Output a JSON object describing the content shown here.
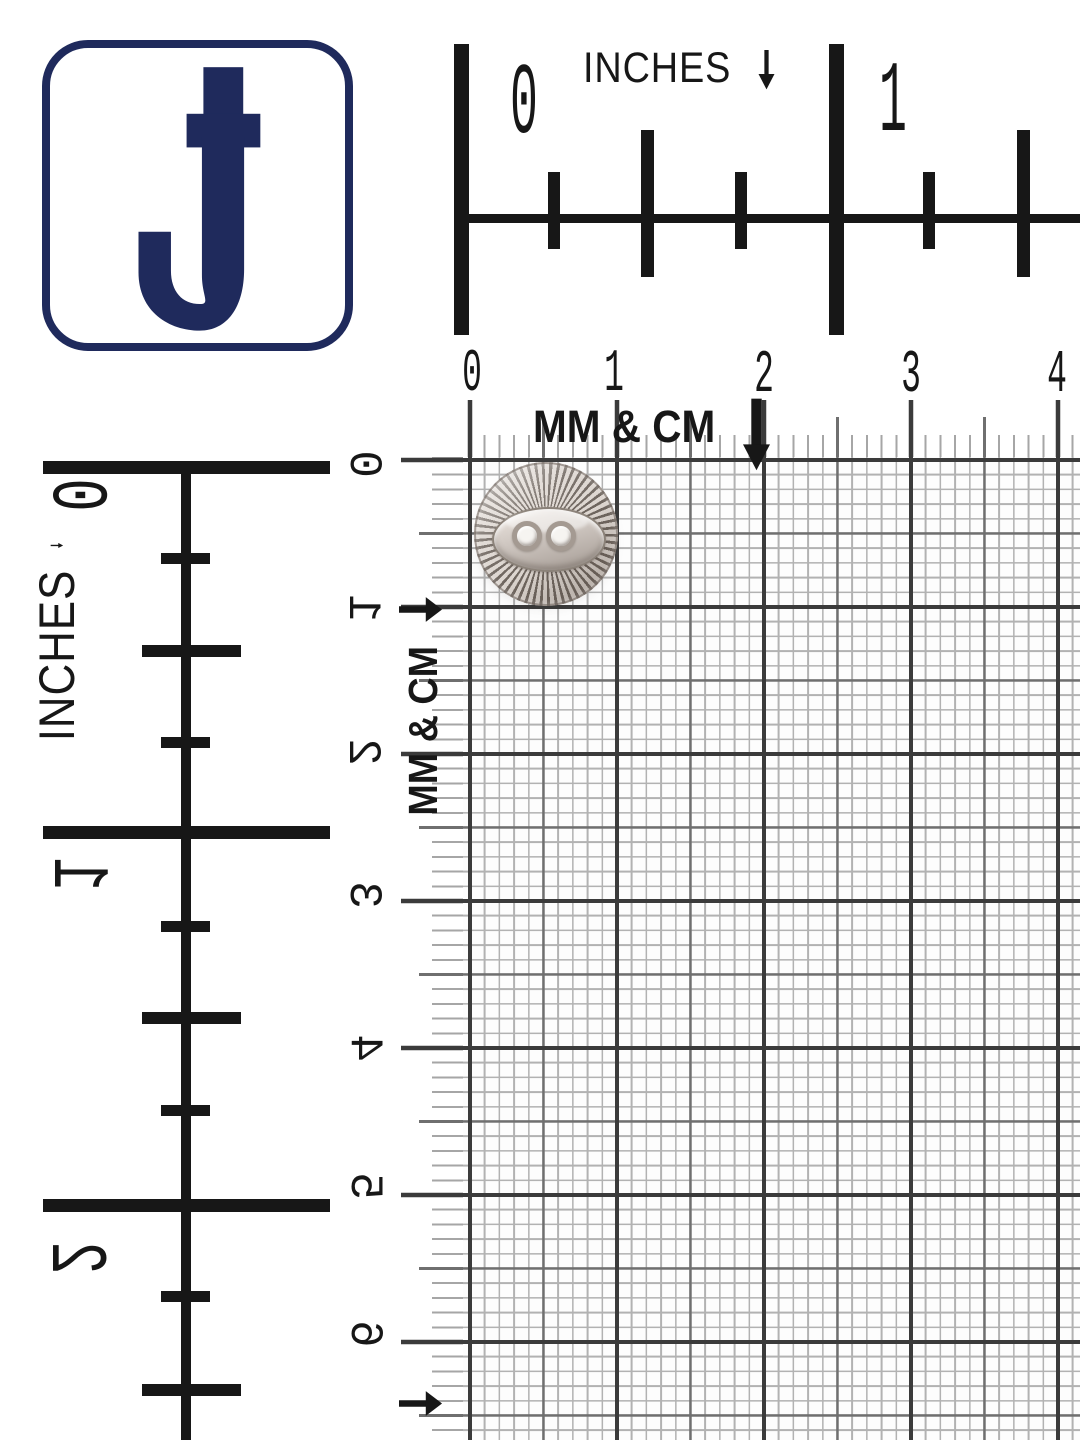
{
  "brand": {
    "logo_letter": "J",
    "logo_color": "#1f2a5c",
    "logo_background": "#ffffff"
  },
  "rulers": {
    "top_inches": {
      "unit": "INCHES",
      "arrow": "down",
      "labels": [
        "0",
        "1"
      ]
    },
    "top_metric": {
      "unit": "MM & CM",
      "arrow": "down",
      "labels": [
        "0",
        "1",
        "2",
        "3",
        "4"
      ]
    },
    "left_inches": {
      "unit": "INCHES",
      "arrow": "right",
      "labels": [
        "0",
        "1",
        "2"
      ]
    },
    "left_metric": {
      "unit": "MM & CM",
      "arrow": "right",
      "labels": [
        "0",
        "1",
        "2",
        "3",
        "4",
        "5",
        "6"
      ]
    }
  },
  "grid": {
    "type": "millimeter graph paper",
    "minor_step_mm": 1,
    "medium_step_mm": 5,
    "major_step_mm": 10
  },
  "specimen": {
    "name": "two-hole metal sewing button",
    "design": "sunburst engraved rim with smooth fisheye oval center",
    "finish": "antique silver nickel",
    "holes": 2,
    "span_on_grid": "0 to 1 cm"
  },
  "colors": {
    "ruler_ink": "#171717",
    "grid_minor": "#b2b2b2",
    "grid_medium": "#6f6f6f",
    "grid_major": "#3b3b3b",
    "metal_light": "#ddd6d0",
    "metal_dark": "#6f665f"
  }
}
